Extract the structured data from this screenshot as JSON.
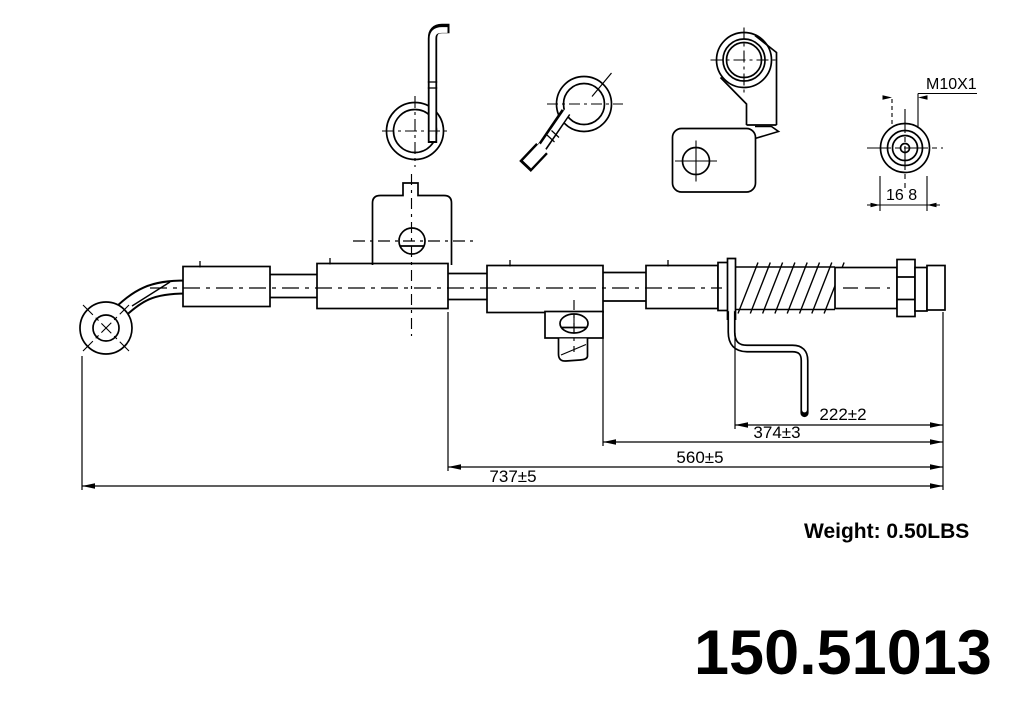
{
  "annotations": {
    "thread_spec": "M10X1",
    "fitting_width": "16 8",
    "dim_222": "222±2",
    "dim_374": "374±3",
    "dim_560": "560±5",
    "dim_737": "737±5"
  },
  "footer": {
    "weight": "Weight: 0.50LBS",
    "part_number": "150.51013"
  },
  "colors": {
    "line": "#000000",
    "background": "#ffffff"
  }
}
